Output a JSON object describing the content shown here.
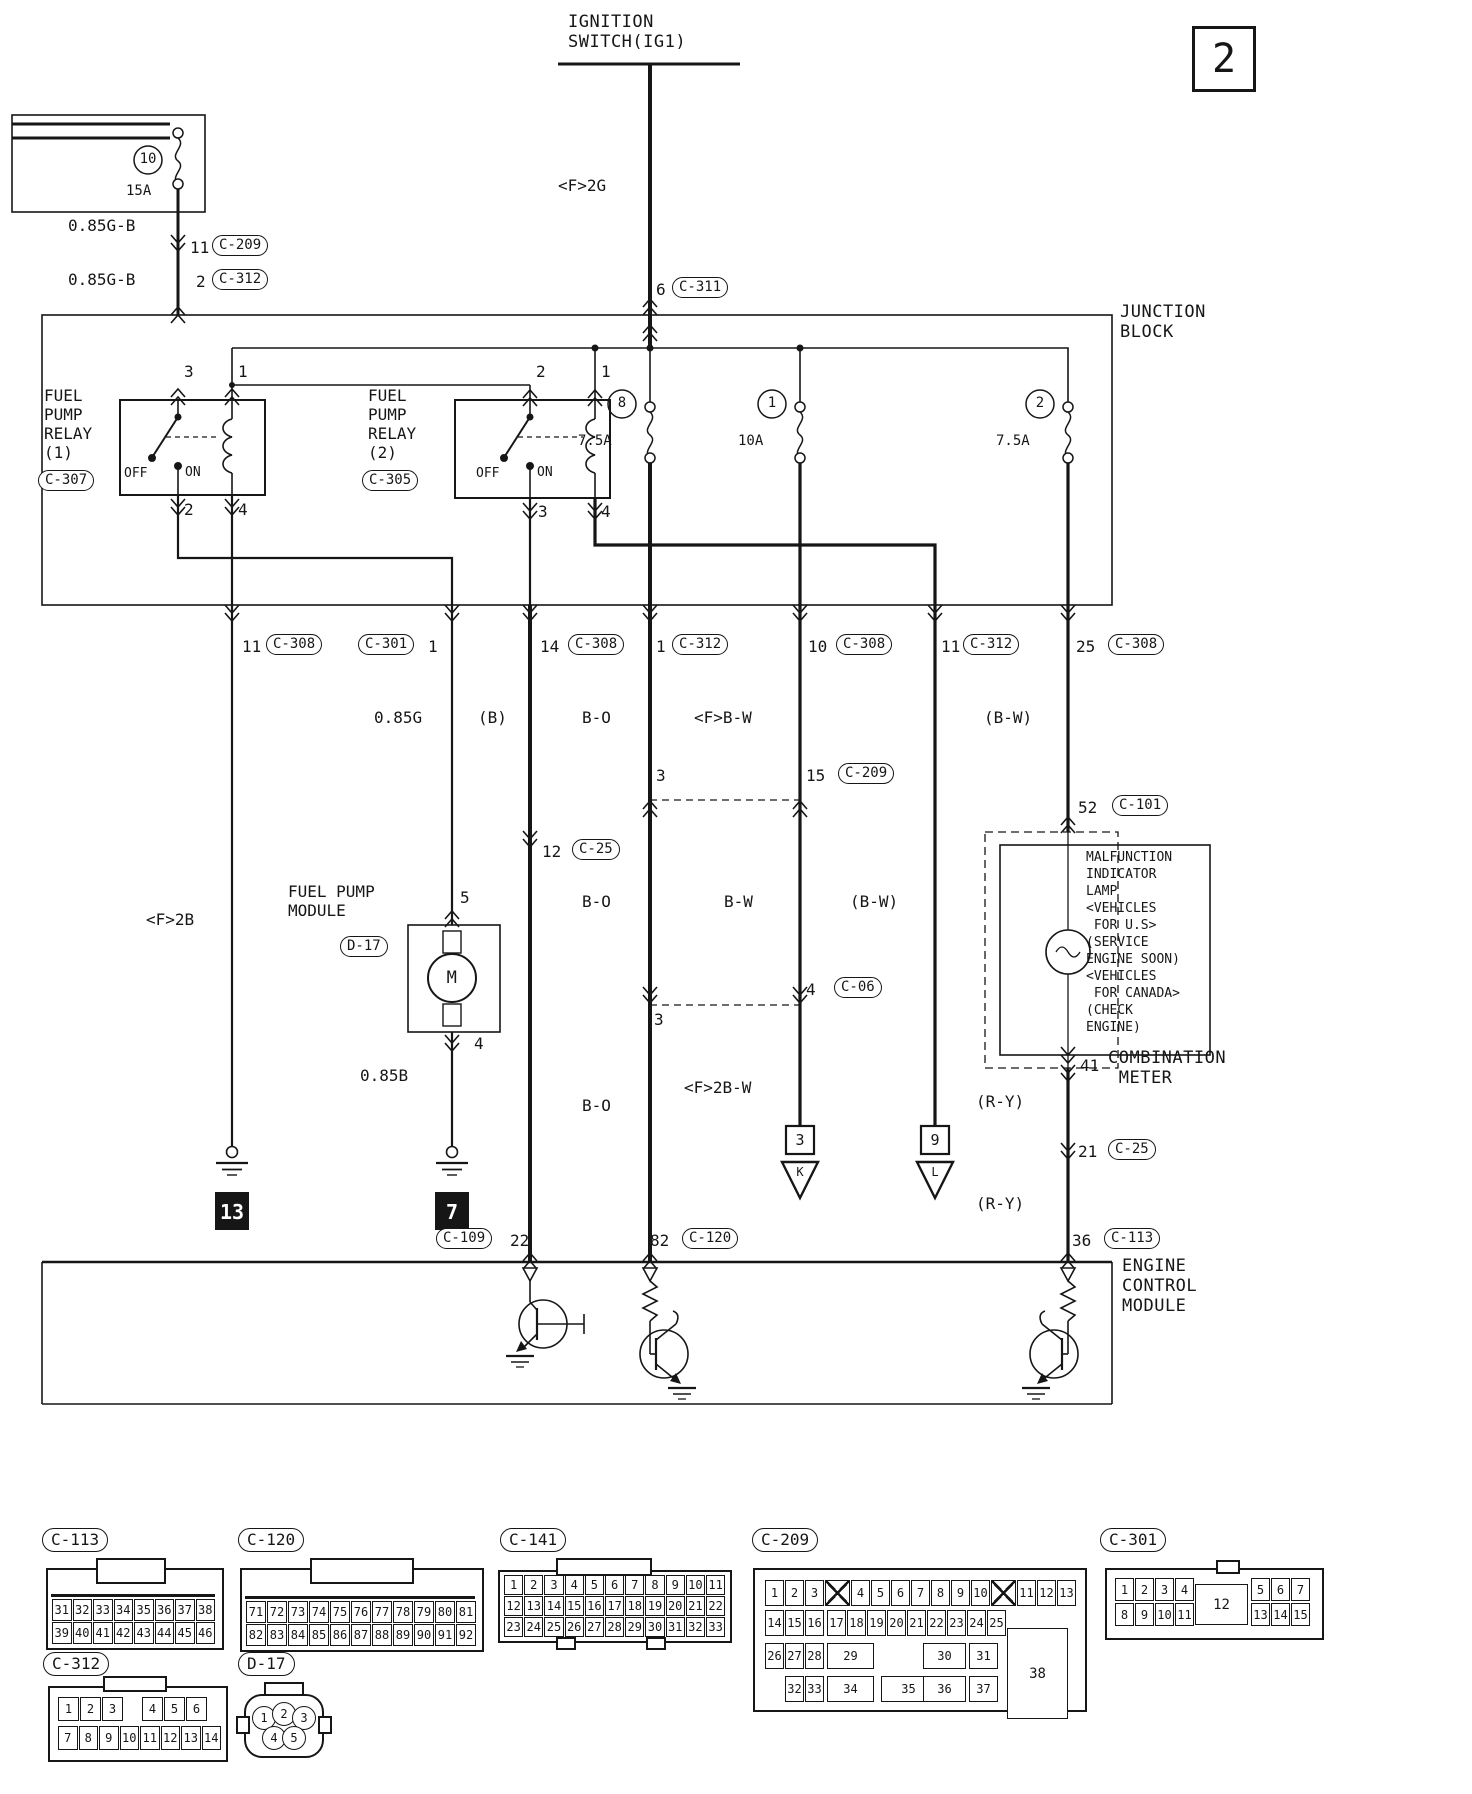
{
  "page_number": "2",
  "ignition_switch": {
    "title": "IGNITION\nSWITCH(IG1)",
    "wire_label": "<F>2G",
    "pin": "6",
    "connector": "C-311"
  },
  "dedicated_fuse": {
    "number": "10",
    "amp": "15A",
    "wire_label_upper": "0.85G-B",
    "wire_label_lower": "0.85G-B",
    "conn_upper_pin": "11",
    "conn_upper": "C-209",
    "conn_lower_pin": "2",
    "conn_lower": "C-312"
  },
  "junction_block": {
    "title": "JUNCTION\nBLOCK",
    "relay1": {
      "name": "FUEL\nPUMP\nRELAY\n(1)",
      "connector": "C-307",
      "off": "OFF",
      "on": "ON",
      "pin_tl": "3",
      "pin_tr": "1",
      "pin_bl": "2",
      "pin_br": "4"
    },
    "relay2": {
      "name": "FUEL\nPUMP\nRELAY\n(2)",
      "connector": "C-305",
      "off": "OFF",
      "on": "ON",
      "pin_tl": "2",
      "pin_tr": "1",
      "pin_bl": "3",
      "pin_br": "4"
    },
    "fuse8": {
      "number": "8",
      "amp": "7.5A"
    },
    "fuse1": {
      "number": "1",
      "amp": "10A"
    },
    "fuse2": {
      "number": "2",
      "amp": "7.5A"
    }
  },
  "branches": {
    "b1": {
      "pin": "11",
      "connector": "C-308",
      "wire": "<F>2B",
      "ground": "13"
    },
    "b2": {
      "connector": "C-301",
      "pin": "1",
      "wire_upper": "0.85G",
      "pump_title": "FUEL PUMP\nMODULE",
      "pump_connector": "D-17",
      "pump_pin_in": "5",
      "pump_pin_out": "4",
      "motor": "M",
      "wire_lower": "0.85B",
      "ground": "7"
    },
    "b3": {
      "pin": "14",
      "connector": "C-308",
      "wire_upper": "(B)",
      "link_pin": "12",
      "link_connector": "C-25",
      "wire_lower": "(B)",
      "ecm_connector": "C-109",
      "ecm_pin": "22"
    },
    "b4": {
      "pin": "1",
      "connector": "C-312",
      "wire_upper": "B-O",
      "cross1_pin": "3",
      "wire_mid": "B-O",
      "cross2_pin": "3",
      "wire_lower": "B-O",
      "ecm_pin": "82",
      "ecm_connector": "C-120"
    },
    "b5": {
      "pin": "10",
      "connector": "C-308",
      "wire_upper": "<F>B-W",
      "cross1_pin": "15",
      "cross1_connector": "C-209",
      "wire_mid": "B-W",
      "cross2_pin": "4",
      "cross2_connector": "C-06",
      "wire_lower": "<F>2B-W",
      "ref_num": "3",
      "ref_letter": "K"
    },
    "b6": {
      "pin": "11",
      "connector": "C-312",
      "wire": "(B-W)",
      "ref_num": "9",
      "ref_letter": "L"
    },
    "b7": {
      "pin": "25",
      "connector": "C-308",
      "wire_upper": "(B-W)",
      "meter_pin_in": "52",
      "meter_conn_in": "C-101",
      "mil_text": "MALFUNCTION\nINDICATOR\nLAMP\n<VEHICLES\n FOR U.S>\n(SERVICE\nENGINE SOON)\n<VEHICLES\n FOR CANADA>\n(CHECK\nENGINE)",
      "meter_pin_out": "41",
      "meter_label": "COMBINATION\n METER",
      "wire_mid_upper": "(R-Y)",
      "link_pin": "21",
      "link_connector": "C-25",
      "wire_mid_lower": "(R-Y)",
      "ecm_pin": "36",
      "ecm_connector": "C-113"
    }
  },
  "ecm": {
    "title": "ENGINE\nCONTROL\nMODULE"
  },
  "pinouts": {
    "c113": {
      "name": "C-113",
      "rows": [
        [
          "31",
          "32",
          "33",
          "34",
          "35",
          "36",
          "37",
          "38"
        ],
        [
          "39",
          "40",
          "41",
          "42",
          "43",
          "44",
          "45",
          "46"
        ]
      ]
    },
    "c120": {
      "name": "C-120",
      "rows": [
        [
          "71",
          "72",
          "73",
          "74",
          "75",
          "76",
          "77",
          "78",
          "79",
          "80",
          "81"
        ],
        [
          "82",
          "83",
          "84",
          "85",
          "86",
          "87",
          "88",
          "89",
          "90",
          "91",
          "92"
        ]
      ]
    },
    "c141": {
      "name": "C-141",
      "rows": [
        [
          "1",
          "2",
          "3",
          "4",
          "5",
          "6",
          "7",
          "8",
          "9",
          "10",
          "11"
        ],
        [
          "12",
          "13",
          "14",
          "15",
          "16",
          "17",
          "18",
          "19",
          "20",
          "21",
          "22"
        ],
        [
          "23",
          "24",
          "25",
          "26",
          "27",
          "28",
          "29",
          "30",
          "31",
          "32",
          "33"
        ]
      ]
    },
    "c209": {
      "name": "C-209",
      "row1": [
        "1",
        "2",
        "3",
        "X",
        "4",
        "5",
        "6",
        "7",
        "8",
        "9",
        "10",
        "X",
        "11",
        "12",
        "13"
      ],
      "row2": [
        "14",
        "15",
        "16",
        "17",
        "18",
        "19",
        "20",
        "21",
        "22",
        "23",
        "24",
        "25"
      ],
      "row3": [
        "26",
        "27",
        "28",
        "29",
        "30",
        "31"
      ],
      "row4": [
        "32",
        "33",
        "34",
        "35",
        "36",
        "37"
      ],
      "big": "38"
    },
    "c301": {
      "name": "C-301",
      "row1_left": [
        "1",
        "2",
        "3",
        "4"
      ],
      "row2_left": [
        "8",
        "9",
        "10",
        "11"
      ],
      "center": "12",
      "row1_right": [
        "5",
        "6",
        "7"
      ],
      "row2_right": [
        "13",
        "14",
        "15"
      ]
    },
    "c312": {
      "name": "C-312",
      "row1_left": [
        "1",
        "2",
        "3"
      ],
      "row1_right": [
        "4",
        "5",
        "6"
      ],
      "row2": [
        "7",
        "8",
        "9",
        "10",
        "11",
        "12",
        "13",
        "14"
      ]
    },
    "d17": {
      "name": "D-17",
      "top": [
        "1",
        "2",
        "3"
      ],
      "bottom": [
        "4",
        "5"
      ]
    }
  }
}
